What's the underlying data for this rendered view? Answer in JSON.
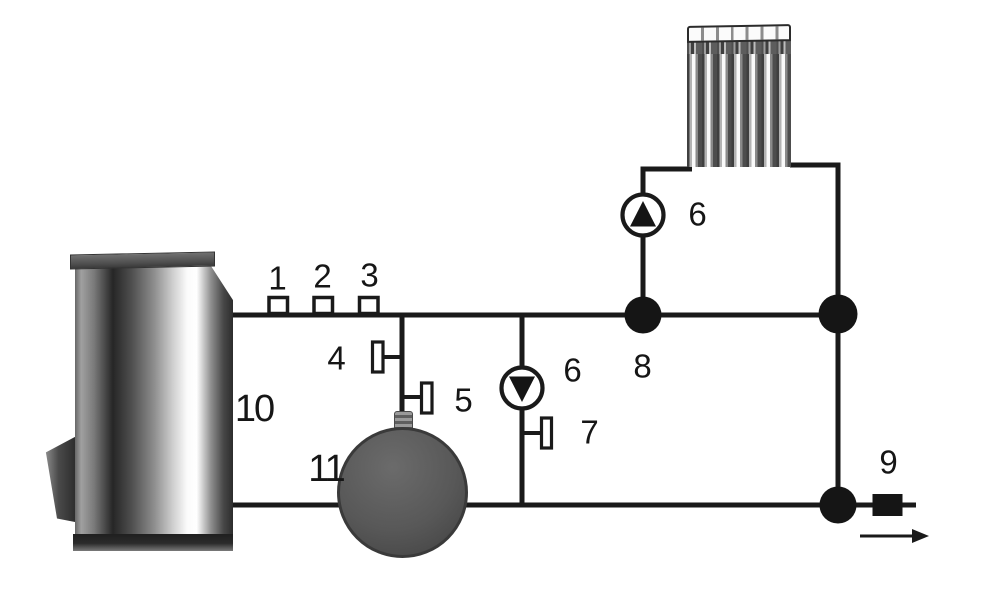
{
  "diagram": {
    "type": "heating-system-schematic",
    "background": "#ffffff",
    "colors": {
      "pipe_line": "#1a1a1a",
      "junction_fill": "#151515",
      "pump_fill": "#ffffff",
      "tank_fill": "#575757",
      "boiler_highlight": "#ffffff",
      "boiler_shadow": "#262626"
    },
    "labels": {
      "sensor_1": "1",
      "sensor_2": "2",
      "sensor_3": "3",
      "valve_4": "4",
      "valve_5": "5",
      "pump_mid_6": "6",
      "valve_7": "7",
      "junction_8": "8",
      "pump_top_6": "6",
      "outlet_9": "9",
      "boiler_10": "10",
      "tank_11": "11"
    }
  }
}
